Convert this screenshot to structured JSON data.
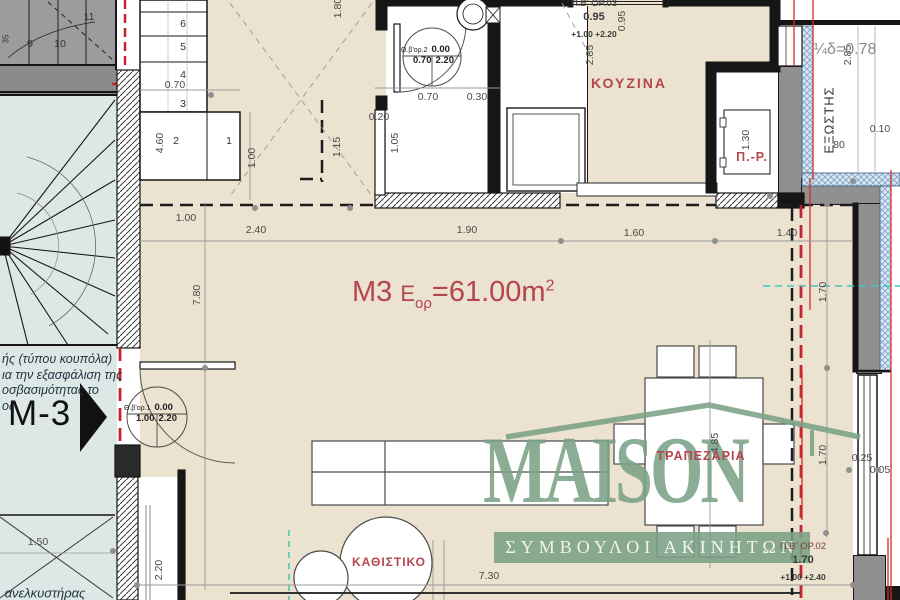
{
  "plan_title": {
    "code": "M3",
    "sym": "Ε",
    "sub": "ορ",
    "rest": "=61.00m",
    "sup": "2"
  },
  "logo": {
    "word": "MAISON",
    "tagline": "ΣΥΜΒΟΥΛΟΙ ΑΚΙΝΗΤΩΝ",
    "color": "#7ca287"
  },
  "note": {
    "lines": [
      "ής (τύπου κουπόλα)",
      "ια την εξασφάλιση της",
      "οσβασιμότητας το",
      "ος"
    ]
  },
  "marker": {
    "label": "Μ-3"
  },
  "window_tags": [
    {
      "code": "Π.Β' ΟΡ.03",
      "size": "0.95",
      "levels": "+1.00  +2.20"
    },
    {
      "code": "Π.Β' ΟΡ.02",
      "size": "1.70",
      "levels": "+1.00  +2.40"
    }
  ],
  "door_tags": [
    {
      "code": "Θ.β'ορ.1",
      "tl": "0.00",
      "bl": "1.00",
      "br": "2.20"
    },
    {
      "code": "Θ.β'ορ.2",
      "tl": "0.00",
      "bl": "0.70",
      "br": "2.20"
    }
  ],
  "room_labels": [
    {
      "t": "ΚΟΥΖΙΝΑ",
      "x": 629,
      "y": 83,
      "c": "red",
      "s": 14,
      "ls": 2
    },
    {
      "t": "Π.-Ρ.",
      "x": 752,
      "y": 157,
      "c": "red",
      "s": 12.5,
      "ls": 1
    },
    {
      "t": "ΤΡΑΠΕΖΑΡΙΑ",
      "x": 701,
      "y": 456,
      "c": "red",
      "s": 12.5,
      "ls": 1
    },
    {
      "t": "ΚΑΘΙΣΤΙΚΟ",
      "x": 389,
      "y": 562,
      "c": "red",
      "s": 12,
      "ls": 1
    },
    {
      "t": "ΕΞΩΣΤΗΣ",
      "x": 829,
      "y": 120,
      "v": true,
      "s": 13,
      "ls": 1
    },
    {
      "t": "¼δ=0.78",
      "x": 845,
      "y": 50,
      "c": "gray",
      "s": 16
    },
    {
      "t": "ανελκυστήρας",
      "x": 45,
      "y": 593,
      "c": "ital",
      "s": 13
    }
  ],
  "dim_labels": [
    {
      "t": "1.00",
      "x": 186,
      "y": 218
    },
    {
      "t": "2.40",
      "x": 256,
      "y": 230
    },
    {
      "t": "1.90",
      "x": 467,
      "y": 230
    },
    {
      "t": "1.60",
      "x": 634,
      "y": 233
    },
    {
      "t": "1.40",
      "x": 787,
      "y": 233
    },
    {
      "t": "0.70",
      "x": 428,
      "y": 97
    },
    {
      "t": "0.30",
      "x": 477,
      "y": 97
    },
    {
      "t": "0.20",
      "x": 379,
      "y": 117
    },
    {
      "t": "0.70",
      "x": 175,
      "y": 85
    },
    {
      "t": "7.30",
      "x": 489,
      "y": 576
    },
    {
      "t": "1.50",
      "x": 38,
      "y": 542
    },
    {
      "t": "0.10",
      "x": 880,
      "y": 129
    },
    {
      "t": "80",
      "x": 839,
      "y": 145
    },
    {
      "t": "0.05",
      "x": 880,
      "y": 470
    },
    {
      "t": "0.25",
      "x": 862,
      "y": 458
    },
    {
      "t": "4.60",
      "x": 160,
      "y": 143,
      "v": true
    },
    {
      "t": "1.00",
      "x": 252,
      "y": 158,
      "v": true
    },
    {
      "t": "1.80",
      "x": 338,
      "y": 8,
      "v": true
    },
    {
      "t": "1.15",
      "x": 337,
      "y": 147,
      "v": true
    },
    {
      "t": "1.05",
      "x": 395,
      "y": 143,
      "v": true
    },
    {
      "t": "2.85",
      "x": 590,
      "y": 55,
      "v": true
    },
    {
      "t": "0.95",
      "x": 622,
      "y": 21,
      "v": true
    },
    {
      "t": "2.85",
      "x": 848,
      "y": 55,
      "v": true
    },
    {
      "t": "1.30",
      "x": 746,
      "y": 140,
      "v": true
    },
    {
      "t": "7.80",
      "x": 197,
      "y": 295,
      "v": true
    },
    {
      "t": "4.85",
      "x": 715,
      "y": 443,
      "v": true
    },
    {
      "t": "1.70",
      "x": 823,
      "y": 292,
      "v": true
    },
    {
      "t": "1.70",
      "x": 823,
      "y": 455,
      "v": true
    },
    {
      "t": "2.20",
      "x": 159,
      "y": 570,
      "v": true
    }
  ],
  "stair_numbers": [
    {
      "t": "6",
      "x": 183,
      "y": 24
    },
    {
      "t": "5",
      "x": 183,
      "y": 47
    },
    {
      "t": "4",
      "x": 183,
      "y": 75
    },
    {
      "t": "3",
      "x": 183,
      "y": 104
    },
    {
      "t": "2",
      "x": 176,
      "y": 141
    },
    {
      "t": "1",
      "x": 229,
      "y": 141
    },
    {
      "t": "9",
      "x": 30,
      "y": 44
    },
    {
      "t": "10",
      "x": 60,
      "y": 44
    },
    {
      "t": "11",
      "x": 89,
      "y": 17
    },
    {
      "t": "35",
      "x": 6,
      "y": 39,
      "v": true,
      "s": 8
    }
  ],
  "nodes": [
    [
      255,
      208
    ],
    [
      350,
      208
    ],
    [
      561,
      241
    ],
    [
      715,
      241
    ],
    [
      205,
      368
    ],
    [
      827,
      368
    ],
    [
      827,
      204
    ],
    [
      826,
      533
    ],
    [
      849,
      470
    ],
    [
      878,
      470
    ],
    [
      770,
      196
    ],
    [
      853,
      181
    ],
    [
      137,
      585
    ],
    [
      853,
      585
    ],
    [
      211,
      95
    ],
    [
      113,
      551
    ]
  ],
  "colors": {
    "accent_red": "#b5454f",
    "line_red": "#d42b2b",
    "dashed_red": "#c3242f",
    "logo_green": "#7ca287",
    "cyan": "#3fc6c6",
    "teal": "#3cc9a6",
    "beige": "#ebe2cf",
    "panel": "#dde7e5",
    "wall_gray": "#909090"
  }
}
